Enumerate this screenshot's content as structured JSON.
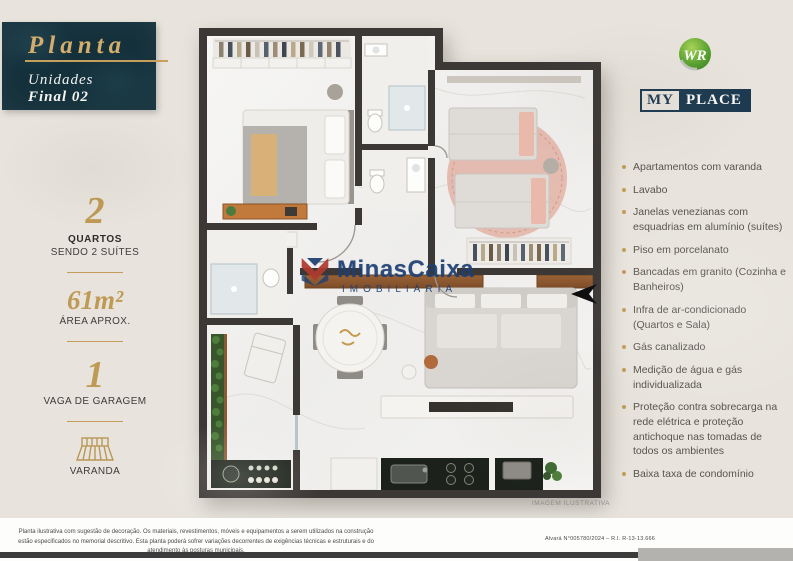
{
  "plan_header": {
    "title": "Planta",
    "line1": "Unidades",
    "line2": "Final 02"
  },
  "specs": {
    "bedrooms": {
      "value": "2",
      "label": "QUARTOS",
      "sublabel": "SENDO 2 SUÍTES"
    },
    "area": {
      "value": "61m²",
      "label": "ÁREA APROX."
    },
    "parking": {
      "value": "1",
      "label": "VAGA DE GARAGEM"
    },
    "balcony": {
      "label": "VARANDA"
    }
  },
  "brand": {
    "monogram": "WR",
    "name_primary": "MY",
    "name_secondary": "PLACE"
  },
  "features": {
    "items": [
      "Apartamentos com varanda",
      "Lavabo",
      "Janelas venezianas com esquadrias em alumínio (suítes)",
      "Piso em porcelanato",
      "Bancadas em granito (Cozinha e Banheiros)",
      "Infra de ar-condicionado (Quartos e Sala)",
      "Gás canalizado",
      "Medição de água e gás individualizada",
      "Proteção contra sobrecarga na rede elétrica e proteção antichoque nas tomadas de todos os ambientes",
      "Baixa taxa de condomínio"
    ]
  },
  "watermark": {
    "brand": "MinasCaixa",
    "tagline": "IMOBILIÁRIA"
  },
  "plan": {
    "caption": "IMAGEM ILUSTRATIVA"
  },
  "footer": {
    "disclaimer_line1": "Planta ilustrativa com sugestão de decoração. Os materiais, revestimentos, móveis e equipamentos a serem utilizados na construção estão especificados",
    "disclaimer_line2": "no memorial descritivo. Esta planta poderá sofrer variações decorrentes de exigências técnicas e estruturais e do atendimento às posturas municipais.",
    "license": "Alvará N°005780/2024 – R.I. R-13-13.666"
  },
  "colors": {
    "accent_gold": "#c49d5c",
    "deep_teal": "#13303b",
    "brand_navy": "#1d3a50",
    "watermark_blue": "#1e3f72",
    "wall": "#3c3835"
  }
}
